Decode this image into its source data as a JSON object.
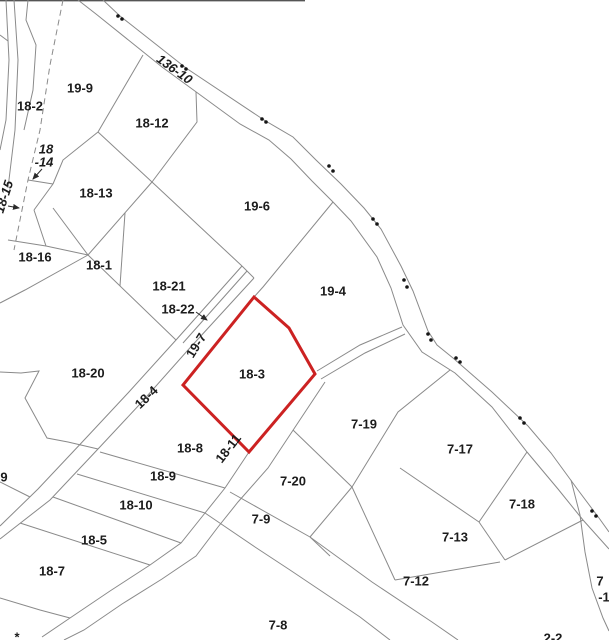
{
  "map": {
    "title": "cadastral-parcel-map",
    "background": "#ffffff",
    "boundary_line_color": "#8a8a8a",
    "selected_parcel": {
      "id": "18-3",
      "outline_color": "#cc2222",
      "outline_width": 3
    },
    "labels": [
      {
        "id": "19-9",
        "text": "19-9",
        "x": 80,
        "y": 89,
        "rot": 0,
        "it": false
      },
      {
        "id": "18-2",
        "text": "18-2",
        "x": 30,
        "y": 107,
        "rot": 0,
        "it": false
      },
      {
        "id": "136-10",
        "text": "136-10",
        "x": 174,
        "y": 70,
        "rot": 36,
        "it": true
      },
      {
        "id": "18-12",
        "text": "18-12",
        "x": 152,
        "y": 124,
        "rot": 0,
        "it": false
      },
      {
        "id": "18-14a",
        "text": "18",
        "x": 46,
        "y": 150,
        "rot": 0,
        "it": true
      },
      {
        "id": "18-14b",
        "text": "-14",
        "x": 44,
        "y": 163,
        "rot": 0,
        "it": true
      },
      {
        "id": "18-15",
        "text": "18-15",
        "x": 5,
        "y": 197,
        "rot": -72,
        "it": true
      },
      {
        "id": "18-13",
        "text": "18-13",
        "x": 96,
        "y": 194,
        "rot": 0,
        "it": false
      },
      {
        "id": "19-6",
        "text": "19-6",
        "x": 257,
        "y": 207,
        "rot": 0,
        "it": false
      },
      {
        "id": "18-16",
        "text": "18-16",
        "x": 35,
        "y": 258,
        "rot": 0,
        "it": false
      },
      {
        "id": "18-1",
        "text": "18-1",
        "x": 99,
        "y": 266,
        "rot": 0,
        "it": false
      },
      {
        "id": "18-21",
        "text": "18-21",
        "x": 169,
        "y": 287,
        "rot": 0,
        "it": false
      },
      {
        "id": "18-22",
        "text": "18-22",
        "x": 178,
        "y": 310,
        "rot": 0,
        "it": false
      },
      {
        "id": "19-4",
        "text": "19-4",
        "x": 333,
        "y": 292,
        "rot": 0,
        "it": false
      },
      {
        "id": "19-7",
        "text": "19-7",
        "x": 197,
        "y": 346,
        "rot": -58,
        "it": false
      },
      {
        "id": "18-3",
        "text": "18-3",
        "x": 252,
        "y": 375,
        "rot": 0,
        "it": false
      },
      {
        "id": "18-20",
        "text": "18-20",
        "x": 88,
        "y": 374,
        "rot": 0,
        "it": false
      },
      {
        "id": "18-4",
        "text": "18-4",
        "x": 147,
        "y": 398,
        "rot": -44,
        "it": false
      },
      {
        "id": "18-11",
        "text": "18-11",
        "x": 229,
        "y": 449,
        "rot": -52,
        "it": false
      },
      {
        "id": "18-8",
        "text": "18-8",
        "x": 190,
        "y": 449,
        "rot": 0,
        "it": false
      },
      {
        "id": "18-9",
        "text": "18-9",
        "x": 163,
        "y": 477,
        "rot": 0,
        "it": false
      },
      {
        "id": "18-10",
        "text": "18-10",
        "x": 136,
        "y": 506,
        "rot": 0,
        "it": false
      },
      {
        "id": "18-5",
        "text": "18-5",
        "x": 94,
        "y": 541,
        "rot": 0,
        "it": false
      },
      {
        "id": "18-7",
        "text": "18-7",
        "x": 52,
        "y": 572,
        "rot": 0,
        "it": false
      },
      {
        "id": "9",
        "text": "9",
        "x": 4,
        "y": 478,
        "rot": 0,
        "it": false
      },
      {
        "id": "7-19",
        "text": "7-19",
        "x": 364,
        "y": 425,
        "rot": 0,
        "it": false
      },
      {
        "id": "7-20",
        "text": "7-20",
        "x": 293,
        "y": 482,
        "rot": 0,
        "it": false
      },
      {
        "id": "7-9",
        "text": "7-9",
        "x": 261,
        "y": 520,
        "rot": 0,
        "it": false
      },
      {
        "id": "7-17",
        "text": "7-17",
        "x": 460,
        "y": 450,
        "rot": 0,
        "it": false
      },
      {
        "id": "7-18",
        "text": "7-18",
        "x": 522,
        "y": 505,
        "rot": 0,
        "it": false
      },
      {
        "id": "7-13",
        "text": "7-13",
        "x": 455,
        "y": 538,
        "rot": 0,
        "it": false
      },
      {
        "id": "7-12",
        "text": "7-12",
        "x": 416,
        "y": 582,
        "rot": 0,
        "it": false
      },
      {
        "id": "7-8",
        "text": "7-8",
        "x": 278,
        "y": 626,
        "rot": 0,
        "it": false
      },
      {
        "id": "7-1a",
        "text": "7",
        "x": 600,
        "y": 582,
        "rot": 0,
        "it": false
      },
      {
        "id": "7-1b",
        "text": "-1",
        "x": 604,
        "y": 598,
        "rot": 0,
        "it": false
      },
      {
        "id": "2-2",
        "text": "2-2",
        "x": 553,
        "y": 639,
        "rot": 0,
        "it": false
      },
      {
        "id": "mark",
        "text": "*",
        "x": 17,
        "y": 638,
        "rot": 0,
        "it": false
      }
    ],
    "arrows": [
      {
        "id": "arrow-18-22",
        "x1": 196,
        "y1": 312,
        "x2": 207,
        "y2": 320
      },
      {
        "id": "arrow-18-14",
        "x1": 42,
        "y1": 169,
        "x2": 33,
        "y2": 179
      },
      {
        "id": "arrow-18-15",
        "x1": 8,
        "y1": 206,
        "x2": 19,
        "y2": 208
      }
    ],
    "boundary_dots": [
      [
        118,
        16
      ],
      [
        122,
        19
      ],
      [
        182,
        66
      ],
      [
        186,
        69
      ],
      [
        262,
        119
      ],
      [
        266,
        122
      ],
      [
        329,
        166
      ],
      [
        333,
        171
      ],
      [
        373,
        219
      ],
      [
        377,
        224
      ],
      [
        404,
        280
      ],
      [
        407,
        287
      ],
      [
        428,
        334
      ],
      [
        431,
        340
      ],
      [
        456,
        358
      ],
      [
        460,
        362
      ],
      [
        520,
        418
      ],
      [
        524,
        423
      ],
      [
        592,
        511
      ],
      [
        596,
        516
      ]
    ]
  }
}
